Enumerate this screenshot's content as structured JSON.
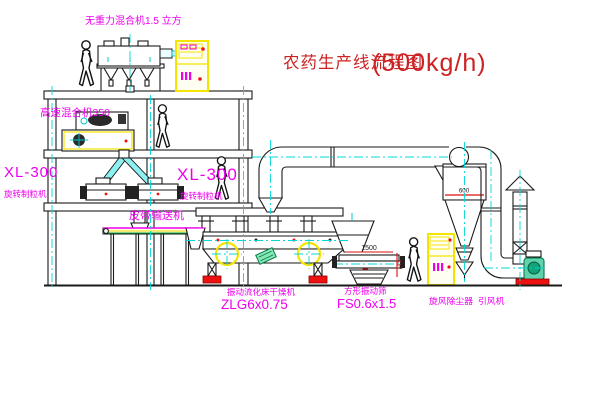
{
  "title": {
    "name": "农药生产线流程图",
    "capacity": "(500kg/h)"
  },
  "labels": {
    "top_mixer": "无重力混合机1.5 立方",
    "floor2_mixer": "高速混合机350",
    "left_granulator_model": "XL-300",
    "left_granulator_name": "旋转制粒机",
    "mid_granulator_model": "XL-300",
    "mid_granulator_name": "旋转制粒机",
    "belt_conveyor": "皮带输送机",
    "dryer_name": "振动流化床干燥机",
    "dryer_model": "ZLG6x0.75",
    "screen_name": "方形振动筛",
    "screen_model": "FS0.6x1.5",
    "cyclone_name": "旋风除尘器",
    "fan_name": "引风机"
  },
  "dimensions": {
    "screen_length": "1500",
    "screen_height": "745",
    "cyclone_diameter": "600"
  },
  "colors": {
    "label_magenta": "#ee00ee",
    "title_red": "#cc2222",
    "centerline_cyan": "#00d8d8",
    "cabinet_yellow": "#f5e400",
    "accent_red": "#ee1111",
    "fan_green": "#18a878",
    "line_black": "#1a1a1a",
    "background": "#ffffff"
  }
}
